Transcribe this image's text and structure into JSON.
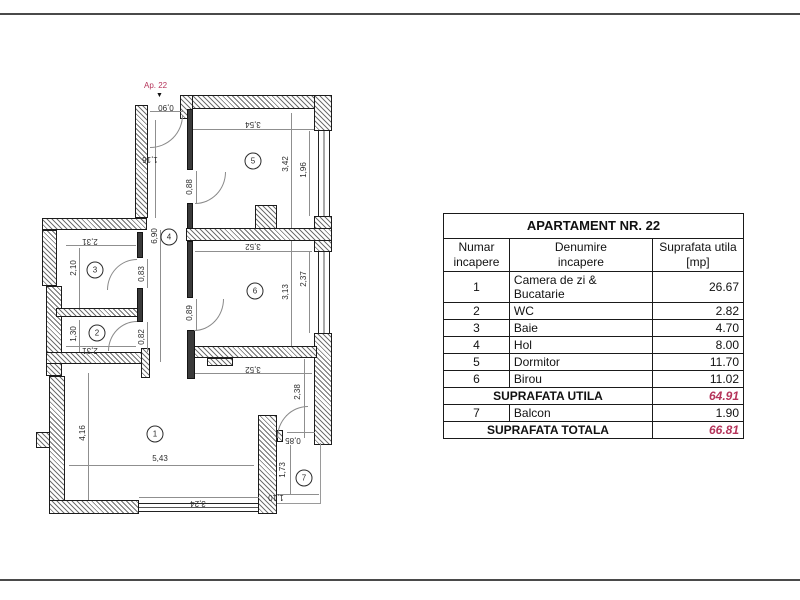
{
  "colors": {
    "accent_red": "#b5345a"
  },
  "plan": {
    "apartment_label": "Ap. 22",
    "entrance_arrow": "▼",
    "rooms": [
      {
        "num": "1",
        "x": 155,
        "y": 434
      },
      {
        "num": "2",
        "x": 97,
        "y": 333
      },
      {
        "num": "3",
        "x": 95,
        "y": 270
      },
      {
        "num": "4",
        "x": 169,
        "y": 237
      },
      {
        "num": "5",
        "x": 253,
        "y": 161
      },
      {
        "num": "6",
        "x": 255,
        "y": 291
      },
      {
        "num": "7",
        "x": 304,
        "y": 478
      }
    ],
    "dimensions": [
      {
        "v": "0,90",
        "x": 166,
        "y": 107,
        "o": "u"
      },
      {
        "v": "3,54",
        "x": 253,
        "y": 124,
        "o": "u"
      },
      {
        "v": "1,16",
        "x": 150,
        "y": 159,
        "o": "u"
      },
      {
        "v": "3,42",
        "x": 286,
        "y": 164,
        "o": "v"
      },
      {
        "v": "1,96",
        "x": 304,
        "y": 170,
        "o": "v"
      },
      {
        "v": "0,88",
        "x": 190,
        "y": 187,
        "o": "v"
      },
      {
        "v": "6,90",
        "x": 155,
        "y": 236,
        "o": "v"
      },
      {
        "v": "2,31",
        "x": 90,
        "y": 241,
        "o": "u"
      },
      {
        "v": "2,10",
        "x": 74,
        "y": 268,
        "o": "v"
      },
      {
        "v": "0,83",
        "x": 142,
        "y": 274,
        "o": "v"
      },
      {
        "v": "3,52",
        "x": 253,
        "y": 246,
        "o": "u"
      },
      {
        "v": "2,37",
        "x": 304,
        "y": 279,
        "o": "v"
      },
      {
        "v": "3,13",
        "x": 286,
        "y": 292,
        "o": "v"
      },
      {
        "v": "1,30",
        "x": 74,
        "y": 334,
        "o": "v"
      },
      {
        "v": "0,82",
        "x": 142,
        "y": 337,
        "o": "v"
      },
      {
        "v": "0,89",
        "x": 190,
        "y": 313,
        "o": "v"
      },
      {
        "v": "2,31",
        "x": 90,
        "y": 350,
        "o": "u"
      },
      {
        "v": "3,52",
        "x": 253,
        "y": 369,
        "o": "u"
      },
      {
        "v": "2,38",
        "x": 298,
        "y": 392,
        "o": "v"
      },
      {
        "v": "4,16",
        "x": 83,
        "y": 433,
        "o": "v"
      },
      {
        "v": "5,43",
        "x": 160,
        "y": 459,
        "o": "h"
      },
      {
        "v": "3,24",
        "x": 198,
        "y": 503,
        "o": "u"
      },
      {
        "v": "0,85",
        "x": 293,
        "y": 440,
        "o": "u"
      },
      {
        "v": "1,73",
        "x": 283,
        "y": 470,
        "o": "v"
      },
      {
        "v": "1,10",
        "x": 276,
        "y": 497,
        "o": "u"
      }
    ]
  },
  "table": {
    "title": "APARTAMENT NR. 22",
    "col_headers": [
      {
        "line1": "Numar",
        "line2": "incapere"
      },
      {
        "line1": "Denumire",
        "line2": "incapere"
      },
      {
        "line1": "Suprafata utila",
        "line2": "[mp]"
      }
    ],
    "rows": [
      {
        "type": "data",
        "num": "1",
        "name": "Camera de zi & Bucatarie",
        "area": "26.67"
      },
      {
        "type": "data",
        "num": "2",
        "name": "WC",
        "area": "2.82"
      },
      {
        "type": "data",
        "num": "3",
        "name": "Baie",
        "area": "4.70"
      },
      {
        "type": "data",
        "num": "4",
        "name": "Hol",
        "area": "8.00"
      },
      {
        "type": "data",
        "num": "5",
        "name": "Dormitor",
        "area": "11.70"
      },
      {
        "type": "data",
        "num": "6",
        "name": "Birou",
        "area": "11.02"
      },
      {
        "type": "total",
        "label": "SUPRAFATA UTILA",
        "area": "64.91"
      },
      {
        "type": "data",
        "num": "7",
        "name": "Balcon",
        "area": "1.90"
      },
      {
        "type": "total",
        "label": "SUPRAFATA TOTALA",
        "area": "66.81"
      }
    ]
  }
}
